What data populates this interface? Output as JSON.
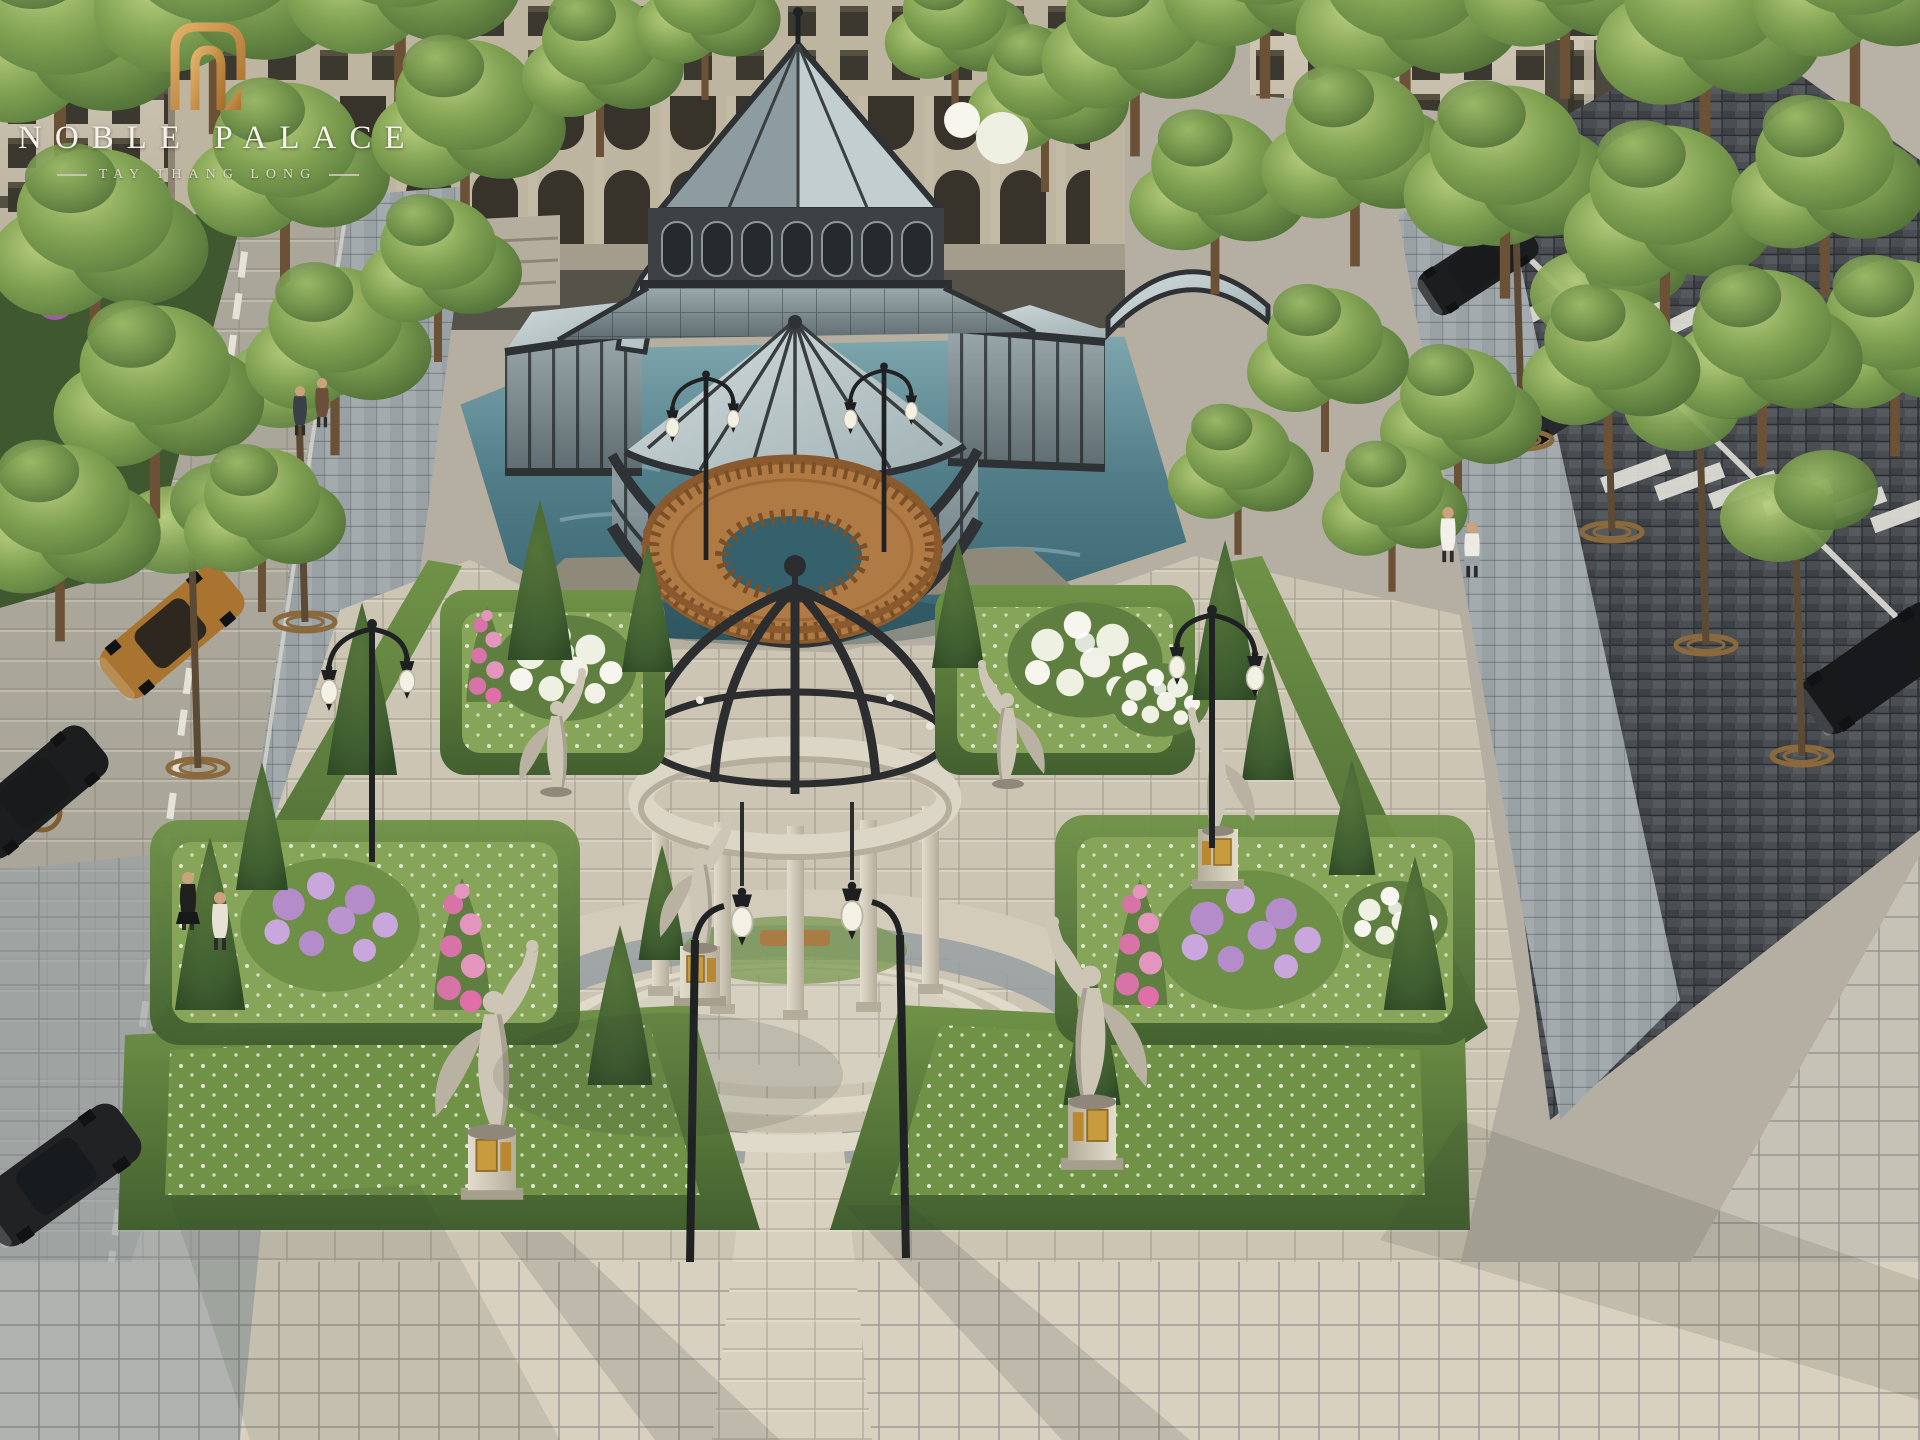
{
  "page": {
    "title": "Noble Palace Tay Thang Long — aerial courtyard rendering"
  },
  "logo": {
    "monogram_icon": "noble-palace-monogram",
    "name": "NOBLE PALACE",
    "tagline": "TAY THANG LONG",
    "gold": "#C08A45",
    "text_color": "#F5F2EA"
  },
  "scene": {
    "type": "aerial-architectural-rendering",
    "setting": "luxury residential courtyard garden",
    "landmarks": [
      {
        "name": "glass-conservatory",
        "description": "black steel and glass pavilion with pyramid roof, arched clerestory and round glass rotunda set in a reflecting pond"
      },
      {
        "name": "reflecting-pond",
        "color": "#4A7682"
      },
      {
        "name": "wooden-deck",
        "description": "circular timber viewing deck with balustrade and twin lantern posts"
      },
      {
        "name": "stone-gazebo",
        "description": "circular stone colonnade with wrought-iron dome ribs, hanging lanterns and circular steps"
      },
      {
        "name": "parterre-garden",
        "description": "boxwood-edged beds, conical topiaries, white and purple rose bushes, pink flower columns, white groundcover blooms"
      },
      {
        "name": "angel-statues",
        "count": 6,
        "description": "winged angel figures on plinths with gold plaques"
      },
      {
        "name": "street-left",
        "vehicles": [
          "gold sedan",
          "black sedan",
          "black sedan"
        ],
        "pedestrians": 4
      },
      {
        "name": "street-right",
        "vehicles": [
          "black sports car",
          "black sedan",
          "black SUV"
        ],
        "pedestrians": 2
      },
      {
        "name": "classical-facades",
        "description": "beige European style blocks with arcade arches framing the courtyard"
      },
      {
        "name": "tree-allees",
        "description": "rows of green street trees with round iron grates"
      }
    ],
    "palette": {
      "water": "#4A7682",
      "glass": "#9FB0B3",
      "iron": "#2B2D2F",
      "stone": "#D8D2C2",
      "paving_warm": "#CCC5B4",
      "paving_gray": "#9AA2A6",
      "road_dark": "#44474B",
      "hedge": "#4F7134",
      "canopy": "#7FA051",
      "wood": "#A96F3C",
      "flower_purple": "#B48CC9",
      "flower_pink": "#D873A8",
      "flower_white": "#F2F1E7"
    }
  }
}
